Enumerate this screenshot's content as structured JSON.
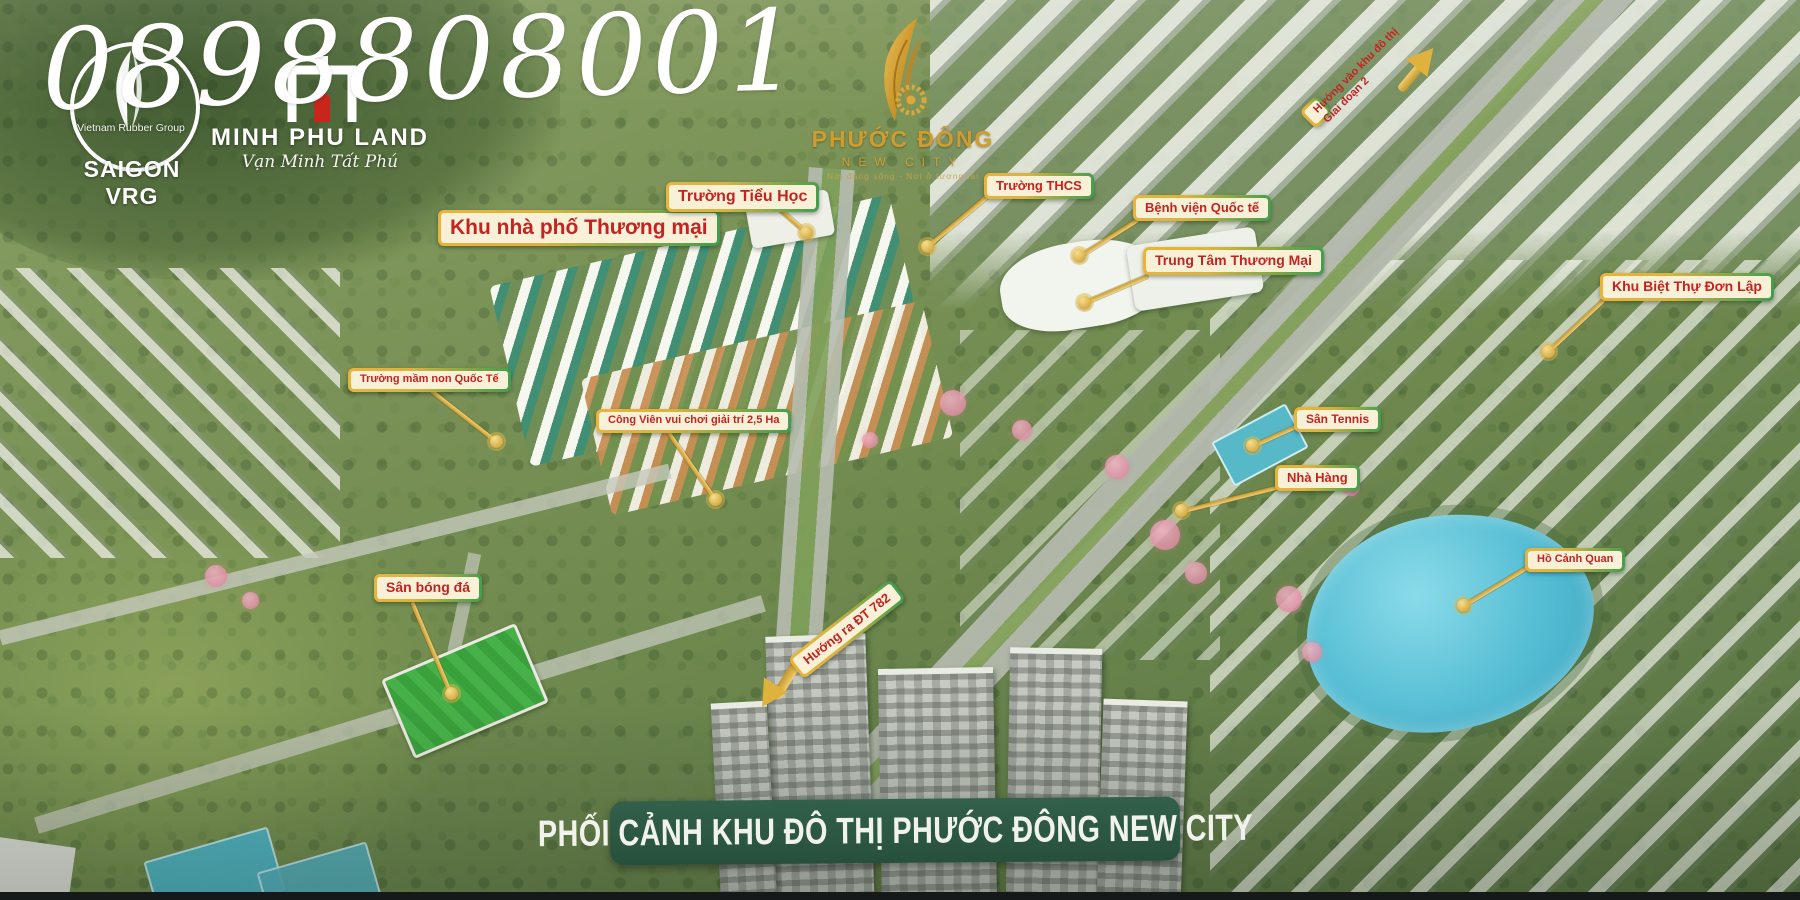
{
  "watermark": {
    "phone": "0898808001"
  },
  "logos": {
    "saigon_vrg": {
      "circle_text": "Vietnam Rubber Group",
      "name": "SAIGON VRG"
    },
    "minh_phu_land": {
      "name": "MINH PHU LAND",
      "slogan": "Vạn Minh Tất Phú"
    },
    "project": {
      "name": "PHƯỚC ĐÔNG",
      "subtitle": "NEW CITY",
      "tagline": "Nơi đáng sống - Nơi ở tương lai"
    }
  },
  "callouts": [
    {
      "text": "Khu nhà phố Thương mại"
    },
    {
      "text": "Trường Tiểu Học"
    },
    {
      "text": "Trường THCS"
    },
    {
      "text": "Bệnh viện Quốc tế"
    },
    {
      "text": "Trung Tâm Thương Mại"
    },
    {
      "text": "Khu Biệt Thự Đơn Lập"
    },
    {
      "text": "Trường mầm non Quốc Tế"
    },
    {
      "text": "Công Viên vui chơi giải trí 2,5 Ha"
    },
    {
      "text": "Sân Tennis"
    },
    {
      "text": "Nhà Hàng"
    },
    {
      "text": "Hồ Cảnh Quan"
    },
    {
      "text": "Sân bóng đá"
    }
  ],
  "road_labels": {
    "phase2": {
      "line1": "Hướng vào khu đô thị",
      "line2": "Giai đoạn 2"
    },
    "dt782": {
      "text": "Hướng ra ĐT 782"
    }
  },
  "banner": {
    "text": "PHỐI CẢNH KHU ĐÔ THỊ PHƯỚC ĐÔNG NEW CITY"
  },
  "colors": {
    "label_bg": "#f8f1d8",
    "label_text": "#c32420",
    "border_gold": "#e9b43a",
    "border_green": "#3f9d4d",
    "banner_bg": "#2d5840",
    "leader_gold": "#d9a93f",
    "lake": "#55bdd4"
  }
}
